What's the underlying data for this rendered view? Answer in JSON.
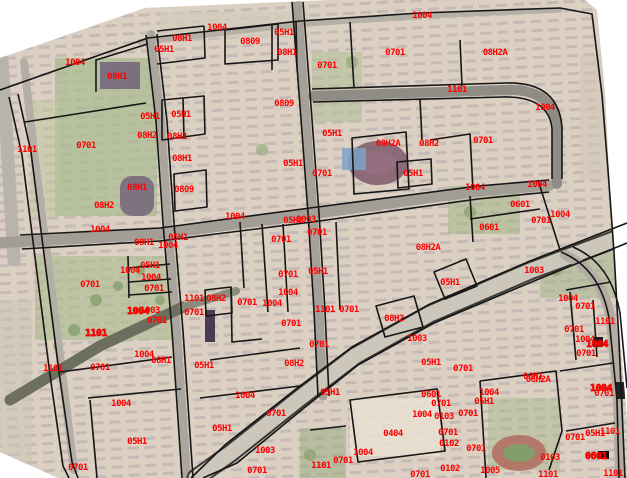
{
  "map": {
    "type": "cadastral-parcel-map-over-satellite-imagery",
    "canvas": {
      "width": 627,
      "height": 478
    },
    "colors": {
      "background": "#ffffff",
      "label_red": "#ff0000",
      "parcel_line": "#161616",
      "base_ground": "#dcd2c3",
      "building_row": "#94849b",
      "park_green": "#a9bb8e",
      "road_gray": "#a29d95",
      "avenue_pale": "#cdc6ba",
      "track_red": "#b06a5e",
      "pool_blue": "#7ba3c6"
    },
    "photo_clip": [
      [
        0,
        58
      ],
      [
        145,
        8
      ],
      [
        330,
        0
      ],
      [
        585,
        0
      ],
      [
        597,
        10
      ],
      [
        605,
        95
      ],
      [
        613,
        250
      ],
      [
        622,
        360
      ],
      [
        627,
        420
      ],
      [
        627,
        478
      ],
      [
        58,
        478
      ],
      [
        0,
        452
      ]
    ],
    "patches": [
      {
        "k": "r",
        "x": 55,
        "y": 58,
        "w": 102,
        "h": 158,
        "f": "#a9bb8e",
        "o": 0.7
      },
      {
        "k": "r",
        "x": 30,
        "y": 100,
        "w": 28,
        "h": 118,
        "f": "#bcc69c",
        "o": 0.45
      },
      {
        "k": "r",
        "x": 160,
        "y": 12,
        "w": 148,
        "h": 26,
        "f": "#d2ccbb",
        "o": 0.75
      },
      {
        "k": "r",
        "x": 312,
        "y": 52,
        "w": 50,
        "h": 70,
        "f": "#b3c096",
        "o": 0.6
      },
      {
        "k": "r",
        "x": 448,
        "y": 186,
        "w": 72,
        "h": 48,
        "f": "#a3b487",
        "o": 0.55
      },
      {
        "k": "r",
        "x": 35,
        "y": 256,
        "w": 142,
        "h": 84,
        "f": "#aabc8e",
        "o": 0.6
      },
      {
        "k": "r",
        "x": 540,
        "y": 252,
        "w": 87,
        "h": 46,
        "f": "#9db284",
        "o": 0.5
      },
      {
        "k": "r",
        "x": 488,
        "y": 398,
        "w": 72,
        "h": 72,
        "f": "#a6b88b",
        "o": 0.45
      },
      {
        "k": "r",
        "x": 300,
        "y": 428,
        "w": 46,
        "h": 50,
        "f": "#93aa7c",
        "o": 0.5
      },
      {
        "k": "r",
        "x": 350,
        "y": 398,
        "w": 90,
        "h": 58,
        "f": "#e9e1d2",
        "o": 0.85
      },
      {
        "k": "r",
        "x": 580,
        "y": 55,
        "w": 47,
        "h": 125,
        "f": "#d0c7b5",
        "o": 0.6
      },
      {
        "k": "r",
        "x": 0,
        "y": 300,
        "w": 32,
        "h": 178,
        "f": "#cac3b3",
        "o": 0.5
      },
      {
        "k": "e",
        "cx": 378,
        "cy": 163,
        "rx": 30,
        "ry": 22,
        "f": "#7c5a6b",
        "o": 0.85
      },
      {
        "k": "e",
        "cx": 378,
        "cy": 163,
        "rx": 18,
        "ry": 12,
        "f": "#96707f",
        "o": 0.9
      },
      {
        "k": "e",
        "cx": 519,
        "cy": 453,
        "rx": 27,
        "ry": 18,
        "f": "#b06a5e",
        "o": 0.85
      },
      {
        "k": "e",
        "cx": 519,
        "cy": 453,
        "rx": 16,
        "ry": 9,
        "f": "#7fa06a",
        "o": 0.95
      },
      {
        "k": "r",
        "x": 342,
        "y": 148,
        "w": 24,
        "h": 22,
        "f": "#7ba3c6",
        "o": 0.85
      },
      {
        "k": "r",
        "x": 100,
        "y": 62,
        "w": 40,
        "h": 27,
        "f": "#6d5b76",
        "o": 0.8
      },
      {
        "k": "r",
        "x": 120,
        "y": 176,
        "w": 34,
        "h": 40,
        "f": "#6f5e78",
        "o": 0.8,
        "rx": 12
      },
      {
        "k": "c",
        "cx": 96,
        "cy": 300,
        "r": 6,
        "f": "#7e9b66",
        "o": 0.7
      },
      {
        "k": "c",
        "cx": 118,
        "cy": 286,
        "r": 5,
        "f": "#7e9b66",
        "o": 0.7
      },
      {
        "k": "c",
        "cx": 74,
        "cy": 330,
        "r": 6,
        "f": "#7e9b66",
        "o": 0.7
      },
      {
        "k": "c",
        "cx": 58,
        "cy": 346,
        "r": 5,
        "f": "#7e9b66",
        "o": 0.7
      },
      {
        "k": "c",
        "cx": 140,
        "cy": 270,
        "r": 5,
        "f": "#7e9b66",
        "o": 0.7
      },
      {
        "k": "c",
        "cx": 262,
        "cy": 150,
        "r": 6,
        "f": "#8aa572",
        "o": 0.6
      },
      {
        "k": "c",
        "cx": 352,
        "cy": 62,
        "r": 6,
        "f": "#8aa572",
        "o": 0.6
      },
      {
        "k": "c",
        "cx": 470,
        "cy": 212,
        "r": 6,
        "f": "#7e9b66",
        "o": 0.6
      },
      {
        "k": "c",
        "cx": 556,
        "cy": 270,
        "r": 6,
        "f": "#7e9b66",
        "o": 0.6
      },
      {
        "k": "c",
        "cx": 40,
        "cy": 200,
        "r": 5,
        "f": "#8aa572",
        "o": 0.6
      },
      {
        "k": "c",
        "cx": 310,
        "cy": 455,
        "r": 6,
        "f": "#7e9b66",
        "o": 0.6
      },
      {
        "k": "c",
        "cx": 160,
        "cy": 300,
        "r": 5,
        "f": "#7e9b66",
        "o": 0.6
      }
    ],
    "roads": [
      {
        "path": "M2,60 L8,160 L14,260",
        "w": 13,
        "c": "#b8b3ab"
      },
      {
        "path": "M24,62 L34,152 L48,262 L62,372 L74,470",
        "w": 8,
        "c": "#b3aea6"
      },
      {
        "path": "M140,42 L300,24 L420,16",
        "w": 6,
        "c": "#b5b0a6"
      },
      {
        "path": "M420,16 L560,10",
        "w": 5,
        "c": "#b5b0a6"
      },
      {
        "path": "M-4,243 L160,234 L311,214 L478,191 L550,185",
        "w": 11,
        "c": "#a29d95"
      },
      {
        "path": "M297,2 L305,106 L313,213 L319,311 L323,396",
        "w": 9,
        "c": "#a5a098"
      },
      {
        "path": "M151,34 L161,121 L168,223 L177,331 L187,478",
        "w": 8,
        "c": "#aaa59d"
      },
      {
        "path": "M313,96 L505,90 Q555,88 557,130 L557,184",
        "w": 10,
        "c": "#8f8b85"
      },
      {
        "path": "M640,230 L530,271 L430,314 L355,356 L300,398 L231,453 L196,478",
        "w": 19,
        "c": "#3a3a38"
      },
      {
        "path": "M640,230 L530,271 L430,314 L355,356 L300,398 L231,453 L196,478",
        "w": 15,
        "c": "#cdc6ba"
      },
      {
        "path": "M565,255 Q602,272 611,320 L618,400 L620,478",
        "w": 10,
        "c": "#b2aca2"
      },
      {
        "path": "M10,400 L100,346 L183,307",
        "w": 11,
        "c": "#6d6f5e"
      },
      {
        "path": "M183,307 L236,291",
        "w": 8,
        "c": "#8b8b7d"
      }
    ],
    "parcel_lines": [
      "M0,90 L148,38 L300,21 L420,13 L560,8 L592,14 L602,95 L608,170 L614,252",
      "M614,252 L619,342 L623,432 L625,478",
      "M18,94 L31,152 L45,262 L59,372 L72,462 L78,478",
      "M9,97 L22,155 L36,265 L50,375 L63,466 L69,478",
      "M20,235 L160,228 L310,208 L478,186 L549,180",
      "M22,249 L160,241 L312,222 L478,199 L549,192",
      "M292,2 L300,106 L308,213 L314,311 L318,396",
      "M303,2 L311,106 L319,213 L325,311 L329,396",
      "M146,35 L156,121 L163,223 L172,331 L182,478",
      "M157,34 L167,121 L174,223 L183,331 L193,478",
      "M312,89 L505,83 Q559,81 562,128 L562,179",
      "M313,102 L503,97 Q549,96 552,129 L552,179",
      "M627,223 L530,261 L430,304 L352,347 L296,389 L226,444 L191,478",
      "M627,243 L534,281 L434,323 L358,365 L304,408 L237,463 L203,478",
      "M561,252 Q600,268 609,318 L617,400 L619,478",
      "M573,247 Q611,263 620,313 L627,388",
      "M96,92 L96,60 L148,44",
      "M157,64 L205,58 L204,26",
      "M157,31 L204,26",
      "M162,140 L205,134 L204,96 L162,100 Z",
      "M183,98 L184,138",
      "M174,174 L206,170 L207,207 L175,211 Z",
      "M225,64 L225,30 L278,24 L278,60 Z",
      "M272,70 L272,24",
      "M296,22 L297,68",
      "M25,122 L146,103",
      "M128,256 L129,298",
      "M128,268 L170,264",
      "M129,282 L171,279",
      "M129,295 L172,292",
      "M60,372 L172,357",
      "M88,398 L181,389",
      "M90,400 L97,478",
      "M262,224 L268,312",
      "M205,290 L231,287 L232,313 L206,316 Z",
      "M283,224 L288,312",
      "M231,287 L232,342 L262,339",
      "M398,188 L432,184 L431,159 L397,162 Z",
      "M352,138 L406,132 L409,189 L354,194 Z",
      "M470,196 L473,242",
      "M470,219 L540,209",
      "M434,272 L466,259 L477,286 L445,299 Z",
      "M376,306 L414,296 L423,327 L385,337 Z",
      "M480,381 L556,371 L562,431 L549,470",
      "M480,381 L486,478",
      "M350,400 L437,389 L445,451 L358,462 Z",
      "M566,290 L611,282",
      "M570,292 L576,360",
      "M560,371 L613,363",
      "M566,431 L615,423",
      "M593,300 L597,357",
      "M336,222 L340,310",
      "M430,140 L470,134 L473,190",
      "M420,100 L422,140",
      "M460,40 L462,86",
      "M350,22 L354,88",
      "M240,222 L244,288",
      "M210,360 L300,348",
      "M200,398 L300,386",
      "M310,430 L346,426",
      "M538,180 L560,250"
    ],
    "black_marks": [
      {
        "x": 593,
        "y": 337,
        "w": 10,
        "h": 10,
        "f": "#1c1c1c"
      },
      {
        "x": 598,
        "y": 451,
        "w": 11,
        "h": 8,
        "f": "#111111"
      },
      {
        "x": 616,
        "y": 382,
        "w": 9,
        "h": 17,
        "f": "#222222"
      },
      {
        "x": 205,
        "y": 310,
        "w": 10,
        "h": 32,
        "f": "#4a3d52"
      }
    ],
    "labels": [
      {
        "t": "1004",
        "x": 217,
        "y": 30
      },
      {
        "t": "1004",
        "x": 422,
        "y": 18
      },
      {
        "t": "1004",
        "x": 75,
        "y": 65
      },
      {
        "t": "08H1",
        "x": 182,
        "y": 41
      },
      {
        "t": "05H1",
        "x": 164,
        "y": 52
      },
      {
        "t": "0809",
        "x": 250,
        "y": 44
      },
      {
        "t": "05H1",
        "x": 284,
        "y": 35
      },
      {
        "t": "08H1",
        "x": 287,
        "y": 55
      },
      {
        "t": "08H2A",
        "x": 495,
        "y": 55
      },
      {
        "t": "0701",
        "x": 395,
        "y": 55
      },
      {
        "t": "0701",
        "x": 327,
        "y": 68
      },
      {
        "t": "0809",
        "x": 284,
        "y": 106
      },
      {
        "t": "1101",
        "x": 27,
        "y": 152
      },
      {
        "t": "0701",
        "x": 86,
        "y": 148
      },
      {
        "t": "08H1",
        "x": 117,
        "y": 79
      },
      {
        "t": "05H1",
        "x": 150,
        "y": 119
      },
      {
        "t": "05H1",
        "x": 181,
        "y": 117
      },
      {
        "t": "08H2",
        "x": 147,
        "y": 138
      },
      {
        "t": "08H2",
        "x": 177,
        "y": 139
      },
      {
        "t": "08H1",
        "x": 182,
        "y": 161
      },
      {
        "t": "0809",
        "x": 184,
        "y": 192
      },
      {
        "t": "08H1",
        "x": 137,
        "y": 190
      },
      {
        "t": "08H2",
        "x": 104,
        "y": 208
      },
      {
        "t": "1004",
        "x": 100,
        "y": 232
      },
      {
        "t": "08H1",
        "x": 144,
        "y": 245
      },
      {
        "t": "1004",
        "x": 168,
        "y": 248
      },
      {
        "t": "05H1",
        "x": 178,
        "y": 240
      },
      {
        "t": "05H1",
        "x": 293,
        "y": 166
      },
      {
        "t": "0701",
        "x": 322,
        "y": 176
      },
      {
        "t": "1004",
        "x": 235,
        "y": 219
      },
      {
        "t": "05H1",
        "x": 293,
        "y": 223
      },
      {
        "t": "1003",
        "x": 306,
        "y": 222
      },
      {
        "t": "0701",
        "x": 317,
        "y": 235
      },
      {
        "t": "0701",
        "x": 281,
        "y": 242
      },
      {
        "t": "05H1",
        "x": 332,
        "y": 136
      },
      {
        "t": "08H2A",
        "x": 388,
        "y": 146
      },
      {
        "t": "08H2",
        "x": 429,
        "y": 146
      },
      {
        "t": "05H1",
        "x": 413,
        "y": 176
      },
      {
        "t": "08H2A",
        "x": 428,
        "y": 250
      },
      {
        "t": "0701",
        "x": 483,
        "y": 143
      },
      {
        "t": "1004",
        "x": 475,
        "y": 190
      },
      {
        "t": "1004",
        "x": 537,
        "y": 187
      },
      {
        "t": "0601",
        "x": 520,
        "y": 207
      },
      {
        "t": "0601",
        "x": 489,
        "y": 230
      },
      {
        "t": "0701",
        "x": 541,
        "y": 223
      },
      {
        "t": "1004",
        "x": 560,
        "y": 217
      },
      {
        "t": "1101",
        "x": 457,
        "y": 92
      },
      {
        "t": "1004",
        "x": 545,
        "y": 110
      },
      {
        "t": "0701",
        "x": 90,
        "y": 287
      },
      {
        "t": "1004",
        "x": 130,
        "y": 273
      },
      {
        "t": "05H1",
        "x": 150,
        "y": 268
      },
      {
        "t": "1004",
        "x": 151,
        "y": 280
      },
      {
        "t": "0701",
        "x": 154,
        "y": 291
      },
      {
        "t": "1004",
        "x": 138,
        "y": 314,
        "b": 1
      },
      {
        "t": "1003",
        "x": 150,
        "y": 313
      },
      {
        "t": "0701",
        "x": 157,
        "y": 323
      },
      {
        "t": "1101",
        "x": 96,
        "y": 336,
        "b": 1
      },
      {
        "t": "1004",
        "x": 144,
        "y": 357
      },
      {
        "t": "08H1",
        "x": 161,
        "y": 363
      },
      {
        "t": "1101",
        "x": 53,
        "y": 371
      },
      {
        "t": "0701",
        "x": 100,
        "y": 370
      },
      {
        "t": "0701",
        "x": 288,
        "y": 277
      },
      {
        "t": "05H1",
        "x": 318,
        "y": 274
      },
      {
        "t": "1004",
        "x": 288,
        "y": 295
      },
      {
        "t": "1101",
        "x": 194,
        "y": 301
      },
      {
        "t": "08H2",
        "x": 216,
        "y": 301
      },
      {
        "t": "0701",
        "x": 247,
        "y": 305
      },
      {
        "t": "1004",
        "x": 272,
        "y": 306
      },
      {
        "t": "0701",
        "x": 194,
        "y": 315
      },
      {
        "t": "1101",
        "x": 325,
        "y": 312
      },
      {
        "t": "0701",
        "x": 349,
        "y": 312
      },
      {
        "t": "0701",
        "x": 291,
        "y": 326
      },
      {
        "t": "0701",
        "x": 319,
        "y": 347
      },
      {
        "t": "05H1",
        "x": 204,
        "y": 368
      },
      {
        "t": "08H2",
        "x": 294,
        "y": 366
      },
      {
        "t": "05H1",
        "x": 450,
        "y": 285
      },
      {
        "t": "1003",
        "x": 534,
        "y": 273
      },
      {
        "t": "08H2",
        "x": 394,
        "y": 321
      },
      {
        "t": "1003",
        "x": 417,
        "y": 341
      },
      {
        "t": "05H1",
        "x": 431,
        "y": 365
      },
      {
        "t": "0701",
        "x": 463,
        "y": 371
      },
      {
        "t": "08H1",
        "x": 533,
        "y": 379
      },
      {
        "t": "1004",
        "x": 568,
        "y": 301
      },
      {
        "t": "0701",
        "x": 585,
        "y": 309
      },
      {
        "t": "1101",
        "x": 605,
        "y": 324
      },
      {
        "t": "0701",
        "x": 574,
        "y": 332
      },
      {
        "t": "1004",
        "x": 585,
        "y": 342
      },
      {
        "t": "1004",
        "x": 597,
        "y": 347,
        "b": 1
      },
      {
        "t": "0701",
        "x": 586,
        "y": 356
      },
      {
        "t": "08H2A",
        "x": 538,
        "y": 382
      },
      {
        "t": "1004",
        "x": 121,
        "y": 406
      },
      {
        "t": "05H1",
        "x": 137,
        "y": 444
      },
      {
        "t": "0701",
        "x": 78,
        "y": 470
      },
      {
        "t": "1004",
        "x": 245,
        "y": 398
      },
      {
        "t": "05H1",
        "x": 222,
        "y": 431
      },
      {
        "t": "0701",
        "x": 276,
        "y": 416
      },
      {
        "t": "1003",
        "x": 265,
        "y": 453
      },
      {
        "t": "0701",
        "x": 257,
        "y": 473
      },
      {
        "t": "05H1",
        "x": 330,
        "y": 395
      },
      {
        "t": "0601",
        "x": 431,
        "y": 397
      },
      {
        "t": "0701",
        "x": 441,
        "y": 406
      },
      {
        "t": "1004",
        "x": 422,
        "y": 417
      },
      {
        "t": "0103",
        "x": 444,
        "y": 419
      },
      {
        "t": "0701",
        "x": 468,
        "y": 416
      },
      {
        "t": "0404",
        "x": 393,
        "y": 436
      },
      {
        "t": "0701",
        "x": 448,
        "y": 435
      },
      {
        "t": "0102",
        "x": 449,
        "y": 446
      },
      {
        "t": "0701",
        "x": 476,
        "y": 451
      },
      {
        "t": "1004",
        "x": 363,
        "y": 455
      },
      {
        "t": "0701",
        "x": 343,
        "y": 463
      },
      {
        "t": "1101",
        "x": 321,
        "y": 468
      },
      {
        "t": "0102",
        "x": 450,
        "y": 471
      },
      {
        "t": "0701",
        "x": 420,
        "y": 477
      },
      {
        "t": "1004",
        "x": 489,
        "y": 395
      },
      {
        "t": "05H1",
        "x": 484,
        "y": 404
      },
      {
        "t": "1004",
        "x": 601,
        "y": 391,
        "b": 1
      },
      {
        "t": "0701",
        "x": 604,
        "y": 396
      },
      {
        "t": "0701",
        "x": 575,
        "y": 440
      },
      {
        "t": "05H1",
        "x": 595,
        "y": 436
      },
      {
        "t": "1101",
        "x": 610,
        "y": 434
      },
      {
        "t": "0103",
        "x": 550,
        "y": 460
      },
      {
        "t": "0601",
        "x": 596,
        "y": 459,
        "b": 1
      },
      {
        "t": "1005",
        "x": 490,
        "y": 473
      },
      {
        "t": "1101",
        "x": 613,
        "y": 476
      },
      {
        "t": "1101",
        "x": 548,
        "y": 477
      }
    ]
  }
}
